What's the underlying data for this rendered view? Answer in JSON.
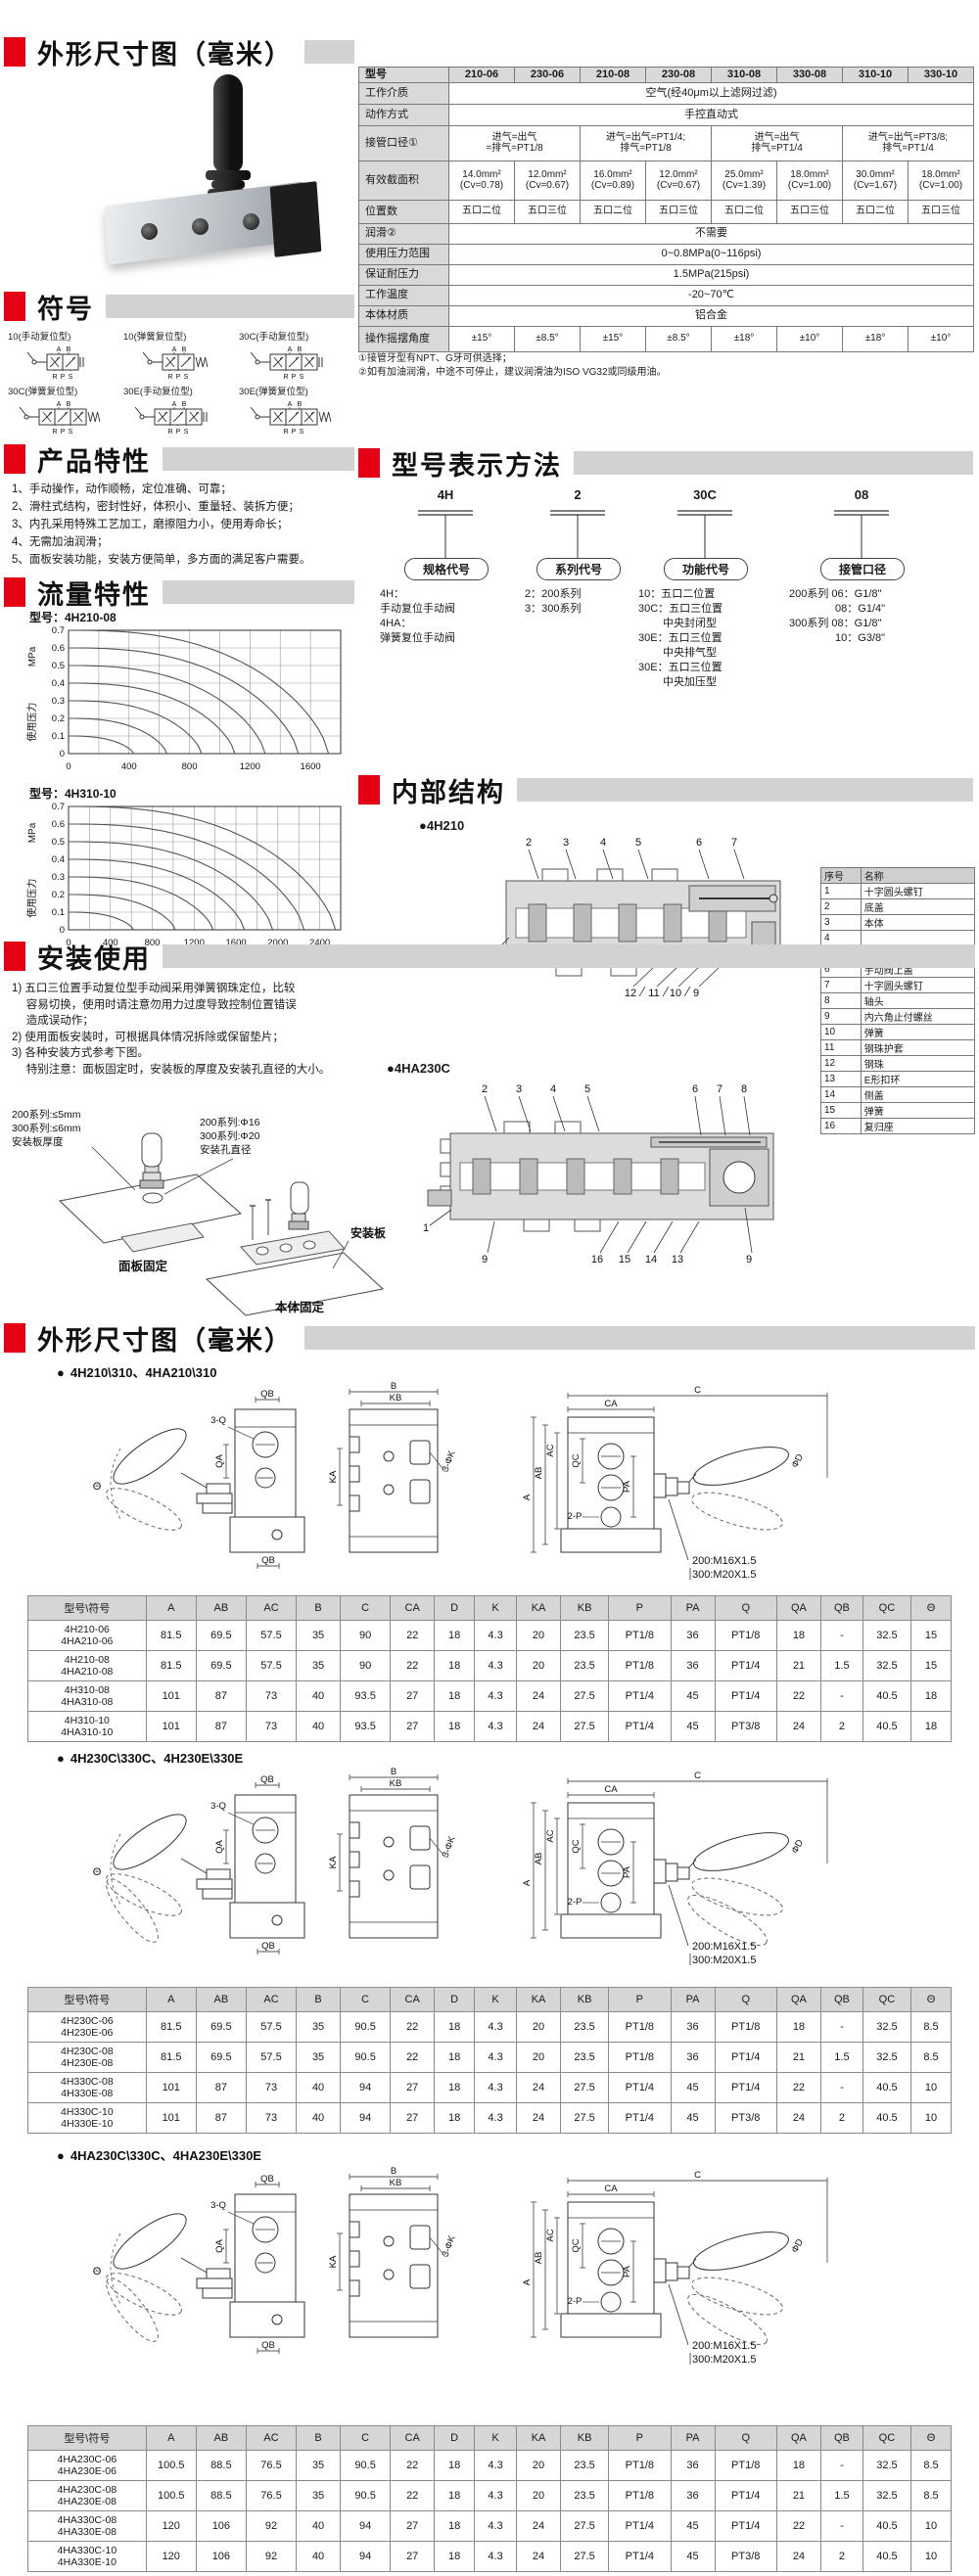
{
  "colors": {
    "accent_red": "#e60014",
    "bar_gray": "#d2d2d2"
  },
  "outline_top": {
    "title": "外形尺寸图（毫米）"
  },
  "spec_table": {
    "col_header_label": "型号",
    "models": [
      "210-06",
      "230-06",
      "210-08",
      "230-08",
      "310-08",
      "330-08",
      "310-10",
      "330-10"
    ],
    "rows": [
      {
        "label": "工作介质",
        "type": "span",
        "value": "空气(经40μm以上滤网过滤)"
      },
      {
        "label": "动作方式",
        "type": "span",
        "value": "手控直动式"
      },
      {
        "label": "接管口径①",
        "type": "group2",
        "values": [
          "进气=出气\n=排气=PT1/8",
          "进气=出气=PT1/4;\n排气=PT1/8",
          "进气=出气\n排气=PT1/4",
          "进气=出气=PT3/8;\n排气=PT1/4"
        ]
      },
      {
        "label": "有效截面积",
        "type": "cells",
        "values": [
          "14.0mm²\n(Cv=0.78)",
          "12.0mm²\n(Cv=0.67)",
          "16.0mm²\n(Cv=0.89)",
          "12.0mm²\n(Cv=0.67)",
          "25.0mm²\n(Cv=1.39)",
          "18.0mm²\n(Cv=1.00)",
          "30.0mm²\n(Cv=1.67)",
          "18.0mm²\n(Cv=1.00)"
        ]
      },
      {
        "label": "位置数",
        "type": "cells",
        "values": [
          "五口二位",
          "五口三位",
          "五口二位",
          "五口三位",
          "五口二位",
          "五口三位",
          "五口二位",
          "五口三位"
        ]
      },
      {
        "label": "润滑②",
        "type": "span",
        "value": "不需要"
      },
      {
        "label": "使用压力范围",
        "type": "span",
        "value": "0~0.8MPa(0~116psi)"
      },
      {
        "label": "保证耐压力",
        "type": "span",
        "value": "1.5MPa(215psi)"
      },
      {
        "label": "工作温度",
        "type": "span",
        "value": "-20~70℃"
      },
      {
        "label": "本体材质",
        "type": "span",
        "value": "铝合金"
      },
      {
        "label": "操作摇摆角度",
        "type": "cells",
        "values": [
          "±15°",
          "±8.5°",
          "±15°",
          "±8.5°",
          "±18°",
          "±10°",
          "±18°",
          "±10°"
        ]
      }
    ],
    "footnotes": [
      "①接管牙型有NPT、G牙可供选择；",
      "②如有加油润滑，中途不可停止，建议润滑油为ISO VG32或同级用油。"
    ]
  },
  "symbols": {
    "title": "符号",
    "ports_top": "A B",
    "ports_bottom": "R P S",
    "items": [
      {
        "label": "10(手动复位型)",
        "positions": 2,
        "spring": false
      },
      {
        "label": "10(弹簧复位型)",
        "positions": 2,
        "spring": true
      },
      {
        "label": "30C(手动复位型)",
        "positions": 3,
        "spring": false
      },
      {
        "label": "30C(弹簧复位型)",
        "positions": 3,
        "spring": true
      },
      {
        "label": "30E(手动复位型)",
        "positions": 3,
        "spring": false
      },
      {
        "label": "30E(弹簧复位型)",
        "positions": 3,
        "spring": true
      }
    ]
  },
  "features": {
    "title": "产品特性",
    "items": [
      "1、手动操作，动作顺畅，定位准确、可靠；",
      "2、滑柱式结构，密封性好，体积小、重量轻、装拆方便；",
      "3、内孔采用特殊工艺加工，磨擦阻力小，使用寿命长；",
      "4、无需加油润滑；",
      "5、面板安装功能，安装方便简单，多方面的满足客户需要。"
    ]
  },
  "flow": {
    "title": "流量特性"
  },
  "chart_data": [
    {
      "type": "line",
      "title": "型号：4H210-08",
      "ylabel": "使用压力 MPa",
      "xlabel": "",
      "xlim": [
        0,
        1800
      ],
      "ylim": [
        0,
        0.7
      ],
      "x_ticks": [
        0,
        400,
        800,
        1200,
        1600
      ],
      "y_ticks": [
        0,
        0.1,
        0.2,
        0.3,
        0.4,
        0.5,
        0.6,
        0.7
      ],
      "grid": true,
      "grid_step_x": 200,
      "series": [
        {
          "name": "P=0.1MPa",
          "start_pressure": 0.1,
          "max_flow": 430
        },
        {
          "name": "P=0.2MPa",
          "start_pressure": 0.2,
          "max_flow": 650
        },
        {
          "name": "P=0.3MPa",
          "start_pressure": 0.3,
          "max_flow": 880
        },
        {
          "name": "P=0.4MPa",
          "start_pressure": 0.4,
          "max_flow": 1100
        },
        {
          "name": "P=0.5MPa",
          "start_pressure": 0.5,
          "max_flow": 1300
        },
        {
          "name": "P=0.6MPa",
          "start_pressure": 0.6,
          "max_flow": 1520
        },
        {
          "name": "P=0.7MPa",
          "start_pressure": 0.7,
          "max_flow": 1720
        }
      ]
    },
    {
      "type": "line",
      "title": "型号：4H310-10",
      "ylabel": "使用压力 MPa",
      "xlabel": "",
      "xlim": [
        0,
        2600
      ],
      "ylim": [
        0,
        0.7
      ],
      "x_ticks": [
        0,
        400,
        800,
        1200,
        1600,
        2000,
        2400
      ],
      "y_ticks": [
        0,
        0.1,
        0.2,
        0.3,
        0.4,
        0.5,
        0.6,
        0.7
      ],
      "grid": true,
      "grid_step_x": 200,
      "series": [
        {
          "name": "P=0.1MPa",
          "start_pressure": 0.1,
          "max_flow": 620
        },
        {
          "name": "P=0.2MPa",
          "start_pressure": 0.2,
          "max_flow": 1020
        },
        {
          "name": "P=0.3MPa",
          "start_pressure": 0.3,
          "max_flow": 1380
        },
        {
          "name": "P=0.4MPa",
          "start_pressure": 0.4,
          "max_flow": 1680
        },
        {
          "name": "P=0.5MPa",
          "start_pressure": 0.5,
          "max_flow": 1950
        },
        {
          "name": "P=0.6MPa",
          "start_pressure": 0.6,
          "max_flow": 2250
        },
        {
          "name": "P=0.7MPa",
          "start_pressure": 0.7,
          "max_flow": 2550
        }
      ]
    }
  ],
  "model_code": {
    "title": "型号表示方法",
    "columns": [
      {
        "code": "4H",
        "bubble": "规格代号",
        "lines": "4H：\n手动复位手动阀\n4HA：\n弹簧复位手动阀"
      },
      {
        "code": "2",
        "bubble": "系列代号",
        "lines": "2：200系列\n3：300系列"
      },
      {
        "code": "30C",
        "bubble": "功能代号",
        "lines": "10：五口二位置\n30C：五口三位置\n　　 中央封闭型\n30E：五口三位置\n　　 中央排气型\n30E：五口三位置\n　　 中央加压型"
      },
      {
        "code": "08",
        "bubble": "接管口径",
        "lines": "200系列  06：G1/8\"\n　　　　  08：G1/4\"\n300系列  08：G1/8\"\n　　　　  10：G3/8\""
      }
    ]
  },
  "internal": {
    "title": "内部结构",
    "diagram1_label": "4H210",
    "diagram2_label": "4HA230C",
    "d1_callouts_top": [
      "2",
      "3",
      "4",
      "5",
      "6",
      "7"
    ],
    "d1_callout_left": "1",
    "d1_callouts_bottom": [
      "12",
      "11",
      "10",
      "9"
    ],
    "d2_callouts_topleft": [
      "2",
      "3",
      "4",
      "5"
    ],
    "d2_callouts_topright": [
      "6",
      "7",
      "8"
    ],
    "d2_callout_left": "1",
    "d2_callout_bl": "9",
    "d2_callouts_bottom": [
      "16",
      "15",
      "14",
      "13"
    ],
    "d2_callout_br": "9",
    "parts": {
      "headers": [
        "序号",
        "名称"
      ],
      "rows": [
        [
          "1",
          "十字圆头螺钉"
        ],
        [
          "2",
          "底盖"
        ],
        [
          "3",
          "本体"
        ],
        [
          "4",
          ""
        ],
        [
          "5",
          ""
        ],
        [
          "6",
          "手动阀上盖"
        ],
        [
          "7",
          "十字圆头螺钉"
        ],
        [
          "8",
          "轴头"
        ],
        [
          "9",
          "内六角止付螺丝"
        ],
        [
          "10",
          "弹簧"
        ],
        [
          "11",
          "钢珠护套"
        ],
        [
          "12",
          "钢珠"
        ],
        [
          "13",
          "E形扣环"
        ],
        [
          "14",
          "侧盖"
        ],
        [
          "15",
          "弹簧"
        ],
        [
          "16",
          "复归座"
        ]
      ]
    }
  },
  "install": {
    "title": "安装使用",
    "notes": "1) 五口三位置手动复位型手动阀采用弹簧钢珠定位，比较\n　  容易切换，使用时请注意勿用力过度导致控制位置错误\n　  造成误动作；\n2) 使用面板安装时，可根据具体情况拆除或保留垫片；\n3) 各种安装方式参考下图。\n　  特别注意：面板固定时，安装板的厚度及安装孔直径的大小。",
    "labels": {
      "thickness": [
        "200系列:≤5mm",
        "300系列:≤6mm",
        "安装板厚度"
      ],
      "hole": [
        "200系列:Φ16",
        "300系列:Φ20",
        "安装孔直径"
      ],
      "panel_fix": "面板固定",
      "plate": "安装板",
      "body_fix": "本体固定"
    }
  },
  "outline_bottom": {
    "title": "外形尺寸图（毫米）",
    "thread_note": [
      "200:M16X1.5",
      "300:M20X1.5"
    ],
    "drawing_labels": {
      "qb": "QB",
      "three_q": "3-Q",
      "qa": "QA",
      "theta": "Θ",
      "b": "B",
      "kb": "KB",
      "ka": "KA",
      "three_phik": "3-ΦK",
      "a": "A",
      "ab": "AB",
      "ac": "AC",
      "qc": "QC",
      "two_p": "2-P",
      "pa": "PA",
      "c": "C",
      "ca": "CA",
      "phid": "ΦD"
    },
    "dim_headers": [
      "型号\\符号",
      "A",
      "AB",
      "AC",
      "B",
      "C",
      "CA",
      "D",
      "K",
      "KA",
      "KB",
      "P",
      "PA",
      "Q",
      "QA",
      "QB",
      "QC",
      "Θ"
    ],
    "subsections": [
      {
        "bullet": "4H210\\310、4HA210\\310",
        "rows": [
          {
            "models": [
              "4H210-06",
              "4HA210-06"
            ],
            "values": [
              "81.5",
              "69.5",
              "57.5",
              "35",
              "90",
              "22",
              "18",
              "4.3",
              "20",
              "23.5",
              "PT1/8",
              "36",
              "PT1/8",
              "18",
              "-",
              "32.5",
              "15"
            ]
          },
          {
            "models": [
              "4H210-08",
              "4HA210-08"
            ],
            "values": [
              "81.5",
              "69.5",
              "57.5",
              "35",
              "90",
              "22",
              "18",
              "4.3",
              "20",
              "23.5",
              "PT1/8",
              "36",
              "PT1/4",
              "21",
              "1.5",
              "32.5",
              "15"
            ]
          },
          {
            "models": [
              "4H310-08",
              "4HA310-08"
            ],
            "values": [
              "101",
              "87",
              "73",
              "40",
              "93.5",
              "27",
              "18",
              "4.3",
              "24",
              "27.5",
              "PT1/4",
              "45",
              "PT1/4",
              "22",
              "-",
              "40.5",
              "18"
            ]
          },
          {
            "models": [
              "4H310-10",
              "4HA310-10"
            ],
            "values": [
              "101",
              "87",
              "73",
              "40",
              "93.5",
              "27",
              "18",
              "4.3",
              "24",
              "27.5",
              "PT1/4",
              "45",
              "PT3/8",
              "24",
              "2",
              "40.5",
              "18"
            ]
          }
        ]
      },
      {
        "bullet": "4H230C\\330C、4H230E\\330E",
        "rows": [
          {
            "models": [
              "4H230C-06",
              "4H230E-06"
            ],
            "values": [
              "81.5",
              "69.5",
              "57.5",
              "35",
              "90.5",
              "22",
              "18",
              "4.3",
              "20",
              "23.5",
              "PT1/8",
              "36",
              "PT1/8",
              "18",
              "-",
              "32.5",
              "8.5"
            ]
          },
          {
            "models": [
              "4H230C-08",
              "4H230E-08"
            ],
            "values": [
              "81.5",
              "69.5",
              "57.5",
              "35",
              "90.5",
              "22",
              "18",
              "4.3",
              "20",
              "23.5",
              "PT1/8",
              "36",
              "PT1/4",
              "21",
              "1.5",
              "32.5",
              "8.5"
            ]
          },
          {
            "models": [
              "4H330C-08",
              "4H330E-08"
            ],
            "values": [
              "101",
              "87",
              "73",
              "40",
              "94",
              "27",
              "18",
              "4.3",
              "24",
              "27.5",
              "PT1/4",
              "45",
              "PT1/4",
              "22",
              "-",
              "40.5",
              "10"
            ]
          },
          {
            "models": [
              "4H330C-10",
              "4H330E-10"
            ],
            "values": [
              "101",
              "87",
              "73",
              "40",
              "94",
              "27",
              "18",
              "4.3",
              "24",
              "27.5",
              "PT1/4",
              "45",
              "PT3/8",
              "24",
              "2",
              "40.5",
              "10"
            ]
          }
        ]
      },
      {
        "bullet": "4HA230C\\330C、4HA230E\\330E",
        "rows": [
          {
            "models": [
              "4HA230C-06",
              "4HA230E-06"
            ],
            "values": [
              "100.5",
              "88.5",
              "76.5",
              "35",
              "90.5",
              "22",
              "18",
              "4.3",
              "20",
              "23.5",
              "PT1/8",
              "36",
              "PT1/8",
              "18",
              "-",
              "32.5",
              "8.5"
            ]
          },
          {
            "models": [
              "4HA230C-08",
              "4HA230E-08"
            ],
            "values": [
              "100.5",
              "88.5",
              "76.5",
              "35",
              "90.5",
              "22",
              "18",
              "4.3",
              "20",
              "23.5",
              "PT1/8",
              "36",
              "PT1/4",
              "21",
              "1.5",
              "32.5",
              "8.5"
            ]
          },
          {
            "models": [
              "4HA330C-08",
              "4HA330E-08"
            ],
            "values": [
              "120",
              "106",
              "92",
              "40",
              "94",
              "27",
              "18",
              "4.3",
              "24",
              "27.5",
              "PT1/4",
              "45",
              "PT1/4",
              "22",
              "-",
              "40.5",
              "10"
            ]
          },
          {
            "models": [
              "4HA330C-10",
              "4HA330E-10"
            ],
            "values": [
              "120",
              "106",
              "92",
              "40",
              "94",
              "27",
              "18",
              "4.3",
              "24",
              "27.5",
              "PT1/4",
              "45",
              "PT3/8",
              "24",
              "2",
              "40.5",
              "10"
            ]
          }
        ]
      }
    ]
  }
}
